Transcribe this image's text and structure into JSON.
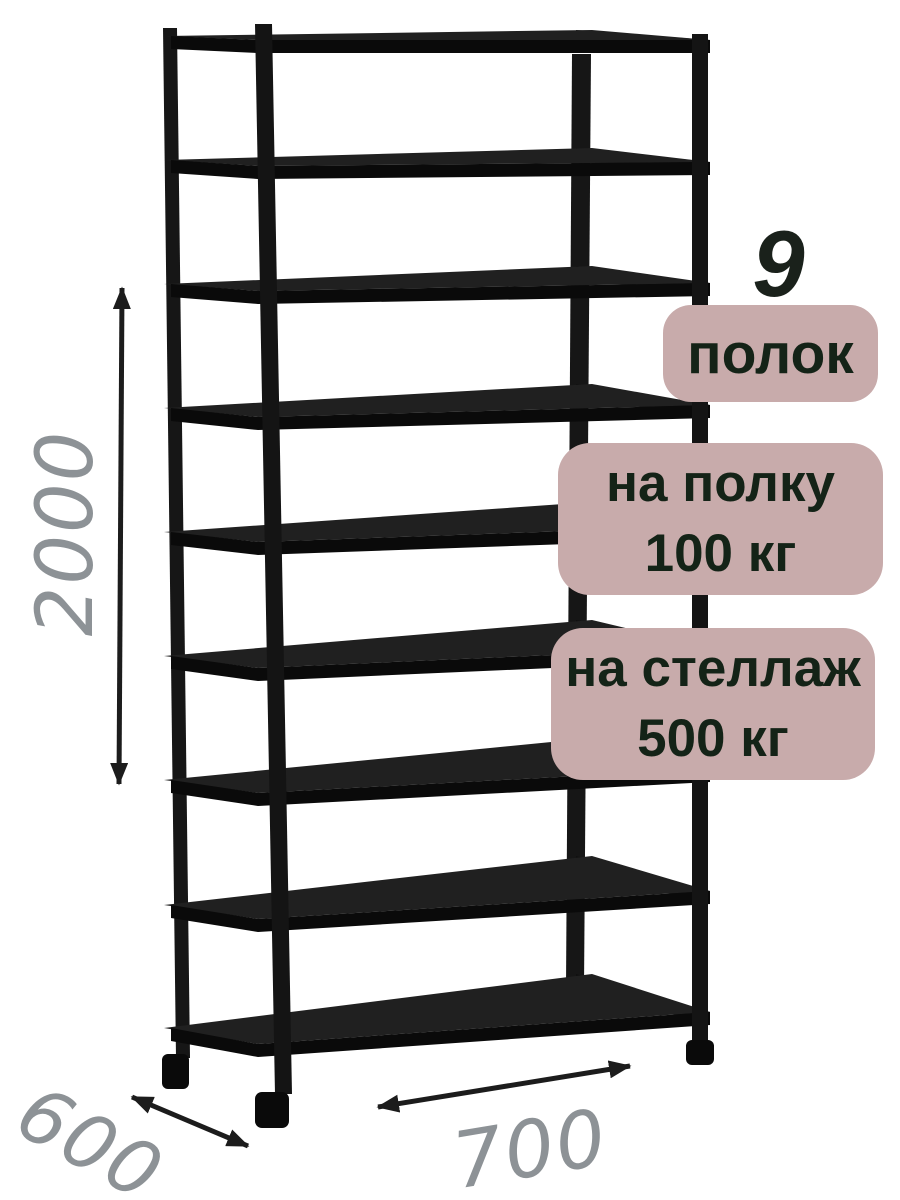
{
  "annotations": {
    "shelf_count": {
      "number": "9",
      "unit": "полок"
    },
    "shelf_capacity": {
      "line1": "на полку",
      "line2": "100 кг"
    },
    "rack_capacity": {
      "line1": "на стеллаж",
      "line2": "500 кг"
    }
  },
  "dimensions": {
    "height": "2000",
    "depth": "600",
    "width": "700"
  },
  "rack": {
    "shelves_total": 9
  },
  "colors": {
    "badge_bg": "#c8abab",
    "badge_text": "#142317",
    "dim_text": "#8d9296",
    "count_text": "#1a211b",
    "rack_color": "#161616",
    "background": "#ffffff"
  }
}
